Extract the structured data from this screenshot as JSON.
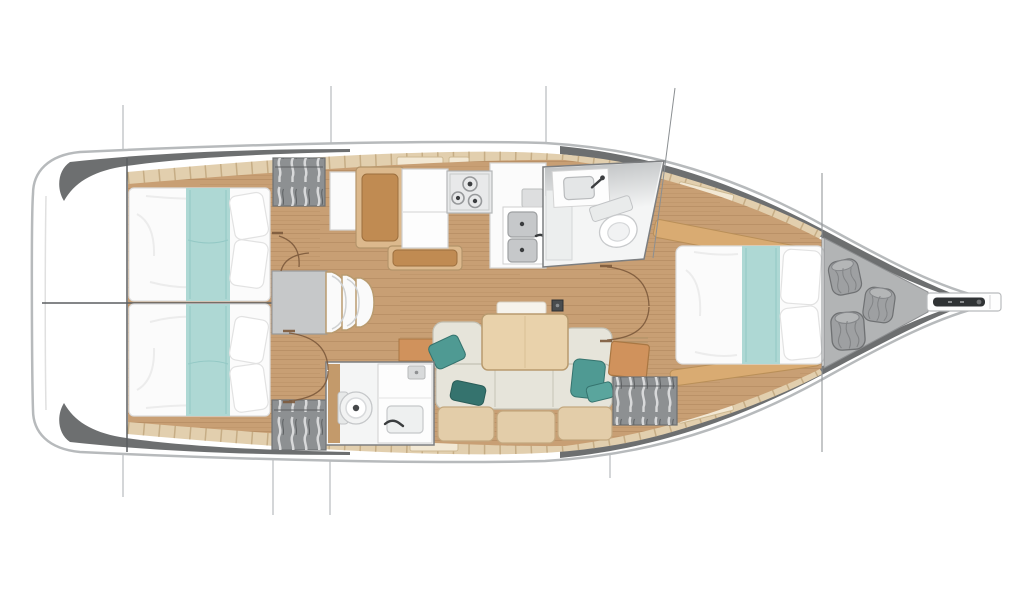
{
  "diagram": {
    "type": "yacht-floor-plan",
    "view": "top-down interior layout",
    "orientation": "bow-right, stern-left",
    "rooms": [
      {
        "id": "lazarette",
        "label": "stern-transom-locker"
      },
      {
        "id": "aft-cabin-port",
        "label": "aft-double-berth-port"
      },
      {
        "id": "aft-cabin-starboard",
        "label": "aft-double-berth-starboard"
      },
      {
        "id": "companionway",
        "label": "companionway-steps-engine-box"
      },
      {
        "id": "galley",
        "label": "galley-stove-sinks-fridge"
      },
      {
        "id": "forward-head",
        "label": "forward-head-toilet-basin"
      },
      {
        "id": "aft-head",
        "label": "aft-head-toilet-basin"
      },
      {
        "id": "salon",
        "label": "salon-sofa-dining-table"
      },
      {
        "id": "forward-cabin",
        "label": "forward-double-berth"
      },
      {
        "id": "sail-locker",
        "label": "bow-sail-locker-fenders"
      }
    ],
    "features": [
      "double-berth x3",
      "teal-bed-runner x3",
      "pillows",
      "hanging-locker x3",
      "three-burner-stove",
      "double-galley-sink",
      "refrigerator",
      "chart-seat",
      "toilet x2",
      "washbasin x2",
      "u-shaped-sofa",
      "teal-throw-pillows",
      "dining-table",
      "mast-post",
      "companionway-steps",
      "fender-bags x3",
      "anchor-bowsprit",
      "door-swing-arcs",
      "rig-section-lines"
    ]
  },
  "colors": {
    "background": "#ffffff",
    "hull_fill": "#ffffff",
    "hull_outline": "#b7babc",
    "bulwark": "#6d6f70",
    "deck_wood": "#e2cfae",
    "deck_tick": "#c6ad85",
    "hatch_light": "#f2e8d4",
    "hatch_edge": "#cdb992",
    "floor_wood": "#c89f74",
    "bulkhead_line": "#5b5e60",
    "section_line": "#a9adb0",
    "stay_line": "#8b8f92",
    "bed_white": "#fbfbfb",
    "bed_outline": "#dcdcdc",
    "runner_teal": "#aed8d4",
    "runner_edge": "#8cc4c0",
    "pillow_white": "#ffffff",
    "pillow_edge": "#e2e2e2",
    "wardrobe_gray": "#8d9092",
    "wardrobe_edge": "#6f7173",
    "engine_gray": "#c6c8c9",
    "engine_edge": "#97999b",
    "step_white": "#fafafa",
    "step_edge": "#b99b6f",
    "galley_white": "#fbfbfb",
    "galley_edge": "#d2d2d2",
    "stove_gray": "#e8e9ea",
    "stove_edge": "#b5b7b8",
    "burner_ring": "#97999b",
    "burner_dot": "#3c3e40",
    "sink_steel": "#c6c8ca",
    "sink_edge": "#9ea0a2",
    "cushion_brown": "#c08b52",
    "cushion_edge": "#9c6f3e",
    "frame_tan": "#dcb98d",
    "frame_edge": "#b3946a",
    "room_white": "#f4f5f5",
    "room_edge": "#7c7e80",
    "fixture_light": "#eef0f0",
    "fixture_edge": "#c6c8ca",
    "faucet_dark": "#3b3d3f",
    "sofa_cushion": "#e6e4da",
    "sofa_edge": "#c2c0b4",
    "sofa_seam": "#cbc9bd",
    "pillow_teal": "#4f9a93",
    "pillow_teal_dark": "#35736e",
    "table_wood": "#e9d2ab",
    "table_edge": "#b89a6e",
    "leaf_white": "#f6f3ec",
    "trim_wood": "#e3cda9",
    "trim_edge": "#c3a87f",
    "seat_orange": "#d0925c",
    "seat_orange_edge": "#a97743",
    "shelf_tan": "#d9ab72",
    "shelf_edge": "#b98f58",
    "locker_gray": "#b2b4b5",
    "locker_edge": "#8e9092",
    "bag_gray": "#9ea0a2",
    "bag_edge": "#6f7173",
    "anchor_dark": "#303335",
    "mast_dark": "#4a4d4f",
    "door_arc": "#7d5a3c"
  }
}
